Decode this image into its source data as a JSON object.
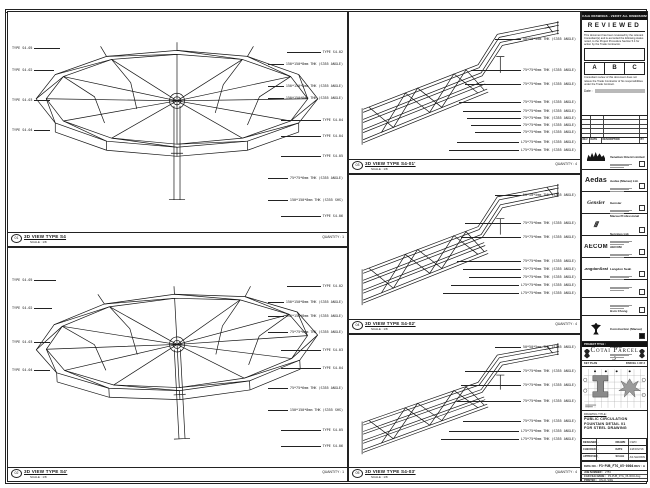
{
  "sheet_note": "DO NOT SCALE DRAWINGS - VERIFY ALL DIMENSIONS ON SITE",
  "review_stamp": {
    "title": "REVIEWED",
    "body1": "This document has been reviewed by the relevant Consultant(s) and is accorded the following status noted, to the Project Procedure Section 5.4 for action by the Trade Contractor.",
    "grades": [
      "A",
      "B",
      "C"
    ],
    "body2": "Consultant review of this document does not relieve the Trade Contractor of his responsibilities under the Trade Contract.",
    "date_label": "Date :"
  },
  "revision_table": {
    "headers": [
      {
        "t": "REV",
        "cls": "rc1"
      },
      {
        "t": "DATE",
        "cls": "rc2"
      },
      {
        "t": "DESCRIPTION",
        "cls": "rc3"
      },
      {
        "t": "BY",
        "cls": "rc4"
      }
    ]
  },
  "consultants": [
    {
      "name": "Venetian Orient Limited",
      "logo": "",
      "kind": "logo-lion",
      "h": "26px",
      "box": "outline"
    },
    {
      "name": "Aedas (Macau) Ltd.",
      "logo": "Aedas",
      "kind": "wm-aedas",
      "h": "22px",
      "box": "outline"
    },
    {
      "name": "Gensler",
      "logo": "Gensler",
      "kind": "wm-gensler",
      "h": "22px",
      "box": "outline"
    },
    {
      "name": "Macau Professional Services Ltd.",
      "logo": "///",
      "kind": "wm-mps",
      "h": "22px",
      "box": "outline"
    },
    {
      "name": "AECOM",
      "logo": "AECOM",
      "kind": "wm-aecom",
      "h": "22px",
      "box": "outline"
    },
    {
      "name": "Langdon Seah",
      "logo": "LangdonSeah",
      "kind": "wm-ls",
      "h": "22px",
      "box": "outline"
    },
    {
      "name": "",
      "logo": "",
      "kind": "wm-none",
      "h": "18px",
      "box": "outline"
    },
    {
      "name": "",
      "logo": "",
      "kind": "wm-none",
      "h": "18px",
      "box": "outline"
    },
    {
      "name": "Hsin Chong Construction (Macau) Co., Ltd.",
      "logo": "",
      "kind": "logo-crest",
      "h": "26px",
      "box": "filled"
    }
  ],
  "project": {
    "bar_label": "PROJECT TITLE :",
    "name": "Cotai Parcel 3",
    "keyplan_label": "KEY PLAN",
    "keyplan_parcel": "PARCEL 1 OF 3"
  },
  "title_block": {
    "drawing_title_label": "DRAWING TITLE:",
    "drawing_title_1": "PUBLIC CIRCULATION",
    "drawing_title_2": "FOUNTAIN DETAIL 01",
    "drawing_title_3": "FOR STEEL DRAWING",
    "fields": [
      {
        "k": "DESIGNED",
        "v": "-"
      },
      {
        "k": "DRAWN",
        "v": "CWO"
      },
      {
        "k": "CHECKED",
        "v": "-"
      },
      {
        "k": "DATE",
        "v": "14/NOV/16"
      },
      {
        "k": "APPROVED",
        "v": "-"
      },
      {
        "k": "SCALE",
        "v": "AS SHOWN"
      }
    ],
    "dwg_label": "DWG NO. :",
    "dwg_no": "P3-PUB_FTG_05-0004",
    "rev": "REV : A",
    "micro_rows": [
      {
        "k": "JOB NUMBER :",
        "v": "2753"
      },
      {
        "k": "CAD FILE NAME :",
        "v": "P3-PUB_FTG_05-0004.dwg"
      },
      {
        "k": "PRINTED :",
        "v": "ON A1 SIZE"
      }
    ]
  },
  "panels": {
    "p1": {
      "ref": "01",
      "title": "3D VIEW TYPE S4",
      "scale": "SCALE : 1/8",
      "qty": "QUANTITY : 1",
      "right_labels": [
        {
          "t": "TYPE S4-02",
          "top": "38px",
          "lead": "34px"
        },
        {
          "t": "150*150*8mm THK (S355 ANGLE)",
          "top": "50px",
          "lead": "16px"
        },
        {
          "t": "150*150*8mm THK (S355 ANGLE)",
          "top": "72px",
          "lead": "16px"
        },
        {
          "t": "150*150*8mm THK (S355 ANGLE)",
          "top": "84px",
          "lead": "16px"
        },
        {
          "t": "TYPE S4-04",
          "top": "106px",
          "lead": "40px"
        },
        {
          "t": "TYPE S4-04",
          "top": "122px",
          "lead": "40px"
        },
        {
          "t": "TYPE S4-05",
          "top": "142px",
          "lead": "40px"
        },
        {
          "t": "75*75*6mm THK (S355 ANGLE)",
          "top": "164px",
          "lead": "20px"
        },
        {
          "t": "150*150*8mm THK (S355 SHS)",
          "top": "186px",
          "lead": "20px"
        },
        {
          "t": "TYPE S4-06",
          "top": "202px",
          "lead": "40px"
        }
      ],
      "left_labels": [
        {
          "t": "TYPE S4-05",
          "top": "34px",
          "lead": "26px"
        },
        {
          "t": "TYPE S4-02",
          "top": "56px",
          "lead": "20px"
        },
        {
          "t": "TYPE S4-03",
          "top": "86px",
          "lead": "16px"
        },
        {
          "t": "TYPE S4-04",
          "top": "116px",
          "lead": "16px"
        }
      ]
    },
    "p2": {
      "ref": "02",
      "title": "3D VIEW TYPE S4'",
      "scale": "SCALE : 1/8",
      "qty": "QUANTITY : 1",
      "right_labels": [
        {
          "t": "TYPE S4-02",
          "top": "36px",
          "lead": "34px"
        },
        {
          "t": "150*150*8mm THK (S355 ANGLE)",
          "top": "52px",
          "lead": "16px"
        },
        {
          "t": "150*150*8mm THK (S355 ANGLE)",
          "top": "66px",
          "lead": "16px"
        },
        {
          "t": "75*75*6mm THK (S355 ANGLE)",
          "top": "82px",
          "lead": "20px"
        },
        {
          "t": "TYPE S4-03",
          "top": "100px",
          "lead": "40px"
        },
        {
          "t": "TYPE S4-04",
          "top": "118px",
          "lead": "40px"
        },
        {
          "t": "75*75*6mm THK (S355 ANGLE)",
          "top": "138px",
          "lead": "20px"
        },
        {
          "t": "150*150*8mm THK (S355 SHS)",
          "top": "160px",
          "lead": "20px"
        },
        {
          "t": "TYPE S4-05",
          "top": "180px",
          "lead": "40px"
        },
        {
          "t": "TYPE S4-06",
          "top": "196px",
          "lead": "40px"
        }
      ],
      "left_labels": [
        {
          "t": "TYPE S4-05",
          "top": "30px",
          "lead": "22px"
        },
        {
          "t": "TYPE S4-02",
          "top": "58px",
          "lead": "18px"
        },
        {
          "t": "TYPE S4-03",
          "top": "92px",
          "lead": "16px"
        },
        {
          "t": "TYPE S4-04",
          "top": "120px",
          "lead": "16px"
        }
      ]
    },
    "p3": {
      "ref": "03",
      "title": "3D VIEW TYPE S4-01'",
      "scale": "SCALE : 1/8",
      "qty": "QUANTITY : 4",
      "right_labels": [
        {
          "t": "50*50*5mm THK (S355 ANGLE)",
          "top": "25px",
          "lead": "26px"
        },
        {
          "t": "75*75*6mm THK (S355 ANGLE)",
          "top": "56px",
          "lead": "50px"
        },
        {
          "t": "75*75*6mm THK (S355 ANGLE)",
          "top": "70px",
          "lead": "56px"
        },
        {
          "t": "75*75*6mm THK (S355 ANGLE)",
          "top": "88px",
          "lead": "62px"
        },
        {
          "t": "75*75*6mm THK (S355 ANGLE)",
          "top": "97px",
          "lead": "58px"
        },
        {
          "t": "75*75*6mm THK (S355 ANGLE)",
          "top": "104px",
          "lead": "54px"
        },
        {
          "t": "75*75*6mm THK (S355 ANGLE)",
          "top": "111px",
          "lead": "50px"
        },
        {
          "t": "75*75*6mm THK (S355 ANGLE)",
          "top": "118px",
          "lead": "46px"
        },
        {
          "t": "L75*75*6mm THK (S355 ANGLE)",
          "top": "128px",
          "lead": "62px"
        },
        {
          "t": "L75*75*6mm THK (S355 ANGLE)",
          "top": "136px",
          "lead": "70px"
        }
      ],
      "left_labels": []
    },
    "p4": {
      "ref": "04",
      "title": "3D VIEW TYPE S4-02'",
      "scale": "SCALE : 1/8",
      "qty": "QUANTITY : 4",
      "right_labels": [
        {
          "t": "50*50*5mm THK (S355 ANGLE)",
          "top": "18px",
          "lead": "26px"
        },
        {
          "t": "75*75*6mm THK (S355 ANGLE)",
          "top": "46px",
          "lead": "56px"
        },
        {
          "t": "75*75*6mm THK (S355 ANGLE)",
          "top": "60px",
          "lead": "60px"
        },
        {
          "t": "75*75*6mm THK (S355 ANGLE)",
          "top": "84px",
          "lead": "64px"
        },
        {
          "t": "75*75*6mm THK (S355 ANGLE)",
          "top": "92px",
          "lead": "58px"
        },
        {
          "t": "75*75*6mm THK (S355 ANGLE)",
          "top": "100px",
          "lead": "52px"
        },
        {
          "t": "L75*75*6mm THK (S355 ANGLE)",
          "top": "108px",
          "lead": "68px"
        },
        {
          "t": "L75*75*6mm THK (S355 ANGLE)",
          "top": "116px",
          "lead": "76px"
        }
      ],
      "left_labels": []
    },
    "p5": {
      "ref": "05",
      "title": "3D VIEW TYPE S4-03'",
      "scale": "SCALE : 1/8",
      "qty": "QUANTITY : 4",
      "right_labels": [
        {
          "t": "50*50*5mm THK (S355 ANGLE)",
          "top": "10px",
          "lead": "26px"
        },
        {
          "t": "75*75*6mm THK (S355 ANGLE)",
          "top": "34px",
          "lead": "56px"
        },
        {
          "t": "75*75*6mm THK (S355 ANGLE)",
          "top": "48px",
          "lead": "60px"
        },
        {
          "t": "75*75*6mm THK (S355 ANGLE)",
          "top": "64px",
          "lead": "64px"
        },
        {
          "t": "75*75*6mm THK (S355 ANGLE)",
          "top": "84px",
          "lead": "58px"
        },
        {
          "t": "L75*75*6mm THK (S355 ANGLE)",
          "top": "94px",
          "lead": "70px"
        },
        {
          "t": "L75*75*6mm THK (S355 ANGLE)",
          "top": "102px",
          "lead": "78px"
        }
      ],
      "left_labels": []
    }
  }
}
